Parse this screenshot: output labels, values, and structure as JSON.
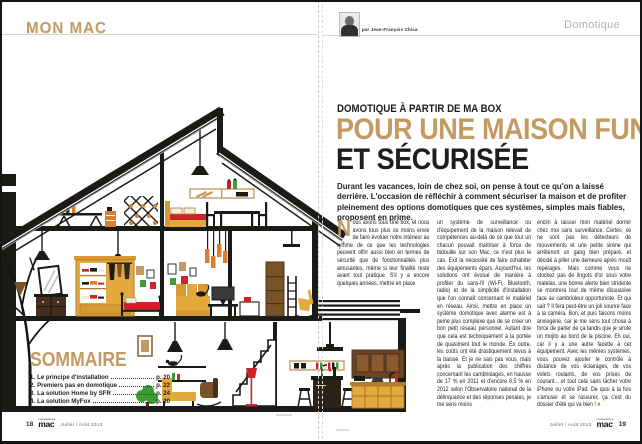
{
  "left_page": {
    "section_label": "MON MAC",
    "page_number": "18",
    "footer_date": "Juillet / Août 2013",
    "brand_top": "compétence",
    "brand_bottom": "mac",
    "sommaire": {
      "title": "SOMMAIRE",
      "items": [
        {
          "num": "1.",
          "label": "Le principe d'installation",
          "page": "p. 20"
        },
        {
          "num": "2.",
          "label": "Premiers pas en domotique",
          "page": "p. 22"
        },
        {
          "num": "3.",
          "label": "La solution Home by SFR",
          "page": "p. 24"
        },
        {
          "num": "4.",
          "label": "La solution MyFox",
          "page": "p. 30"
        }
      ]
    }
  },
  "right_page": {
    "category_label": "Domotique",
    "byline": "par Jean-François Chica",
    "page_number": "19",
    "footer_date": "Juillet / Août 2013",
    "brand_top": "compétence",
    "brand_bottom": "mac",
    "kicker": "DOMOTIQUE À PARTIR DE MA BOX",
    "title_line1": "POUR UNE MAISON FUN",
    "title_line2": "ET SÉCURISÉE",
    "intro": "Durant les vacances, loin de chez soi, on pense à tout ce qu'on a laissé derrière. L'occasion de réfléchir à comment sécuriser la maison et de profiter pleinement des options domotiques que ces systèmes, simples mais fiables, proposent en prime.",
    "drop_cap": "N",
    "col1": "ous avons tous une box, et nous avons tous plus ou moins envie de faire évoluer notre intérieur au rythme de ce que les technologies peuvent offrir aussi bien en termes de sécurité que de fonctionnalités plus amusantes, même si leur finalité reste avant tout pratique. S'il y a encore quelques années, mettre en place",
    "col2": "un système de surveillance ou d'équipement de la maison relevait de compétences au-delà de ce que tout un chacun pouvait maîtriser à force de bidouille sur son Mac, ce n'est plus le cas. Exit la nécessité de faire cohabiter des équipements épars. Aujourd'hui, les solutions ont évolué de manière à profiter du sans-fil (Wi-Fi, Bluetooth, radio) et de la simplicité d'installation que l'on connaît concernant le matériel en réseau. Ainsi, mettre en place un système domotique avec alarme est à peine plus complexe que de se créer un bon petit réseau personnel. Autant dire que cela est techniquement à la portée de quasiment tout le monde. En outre, les coûts ont été drastiquement revus à la baisse. Et je ne sais pas vous, mais après la publication des chiffres concernant les cambriolages, en hausse de 17 % en 2011 et d'encore 8,5 % en 2012 selon l'Observatoire national de la délinquance et des réponses pénales, je me sens moins",
    "col3": "enclin à laisser mon matériel dormir chez moi sans surveillance. Certes, ce ne sont pas les détecteurs de mouvements et une petite sirène qui arrêteront un gang bien préparé, et décidé à piller une demeure après moult repérages. Mais comme vous ne stockez pas de lingots d'or sous votre matelas, une bonne alerte bien stridente se montrera tout de même dissuasive face au cambrioleur opportuniste. Et qui sait ? Il fera peut-être un joli sourire face à la caméra. Bon, et puis faisons moins anxiogène, car je me sens tout chose à force de parler de ça tandis que je sirote un mojito au bord de la piscine. Eh oui, car il y a une autre facette à cet équipement. Avec les mêmes systèmes, vous pouvez ajouter le contrôle à distance de vos éclairages, de vos volets roulants, de vos prises de courant... et tout cela sans lâcher votre iPhone ou votre iPad. De quoi à la fois s'amuser et se rassurer, ça c'est du dossier d'été qui va bien ! ",
    "end_mark": "■"
  },
  "palette": {
    "accent_tan": "#c49a63",
    "headline_black": "#1d1d1b",
    "furniture_gold": "#e3a93d",
    "furniture_orange": "#dd7f2a",
    "accent_red": "#cc2229",
    "wood_brown": "#7a5228",
    "dark_brown": "#46301d",
    "leaf_green": "#3f9b35",
    "rule_gray": "#d6d6d6",
    "category_gray": "#b3b3b3"
  }
}
